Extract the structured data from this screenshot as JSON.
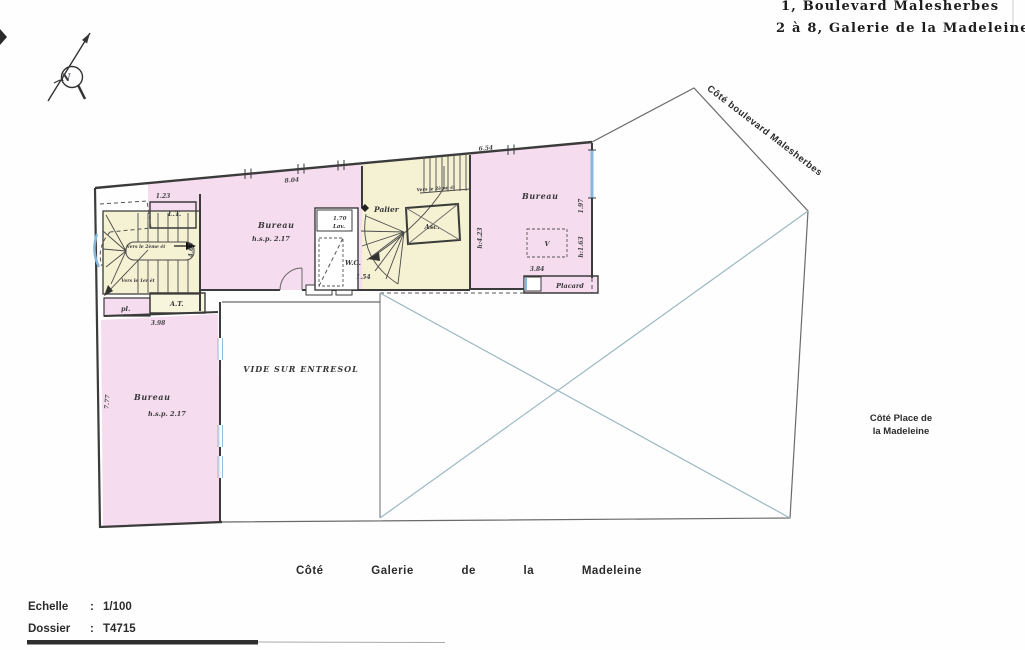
{
  "header": {
    "address_line1": "1, Boulevard Malesherbes",
    "address_line2": "2 à 8, Galerie de la Madeleine"
  },
  "compass": {
    "north_label": "N"
  },
  "sides": {
    "boulevard": "Côté boulevard Malesherbes",
    "place_line1": "Côté Place de",
    "place_line2": "la Madeleine",
    "galerie": "Côté Galerie de la Madeleine"
  },
  "footer": {
    "scale_label": "Echelle",
    "scale_value": "1/100",
    "dossier_label": "Dossier",
    "dossier_value": "T4715",
    "separator": ":"
  },
  "rooms": {
    "bureau_top": {
      "name": "Bureau",
      "height": "h.s.p. 2.17"
    },
    "bureau_right": {
      "name": "Bureau"
    },
    "bureau_left": {
      "name": "Bureau",
      "height": "h.s.p. 2.17"
    },
    "palier": "Palier",
    "ascenseur": "Asc.",
    "wc": "W.C.",
    "lavabo": "Lav.",
    "lt": "L.T.",
    "at": "A.T.",
    "pl": "pl.",
    "placard": "Placard",
    "vide": "VIDE SUR ENTRESOL",
    "velux": "V"
  },
  "stairs": {
    "note_up_main": "Vers le 2ème ét",
    "note_down_main": "Vers le 1er ét",
    "note_up_core": "Vers le 2ème ét"
  },
  "dimensions": {
    "d123": "1.23",
    "d463": "4.63",
    "d804": "8.04",
    "d654": "6.54",
    "d170": "1.70",
    "d154": "1.54",
    "d398": "3.98",
    "d777": "7.77",
    "d384": "3.84",
    "h423": "h:4.23",
    "d197": "1.97",
    "h163": "h:1.63"
  }
}
